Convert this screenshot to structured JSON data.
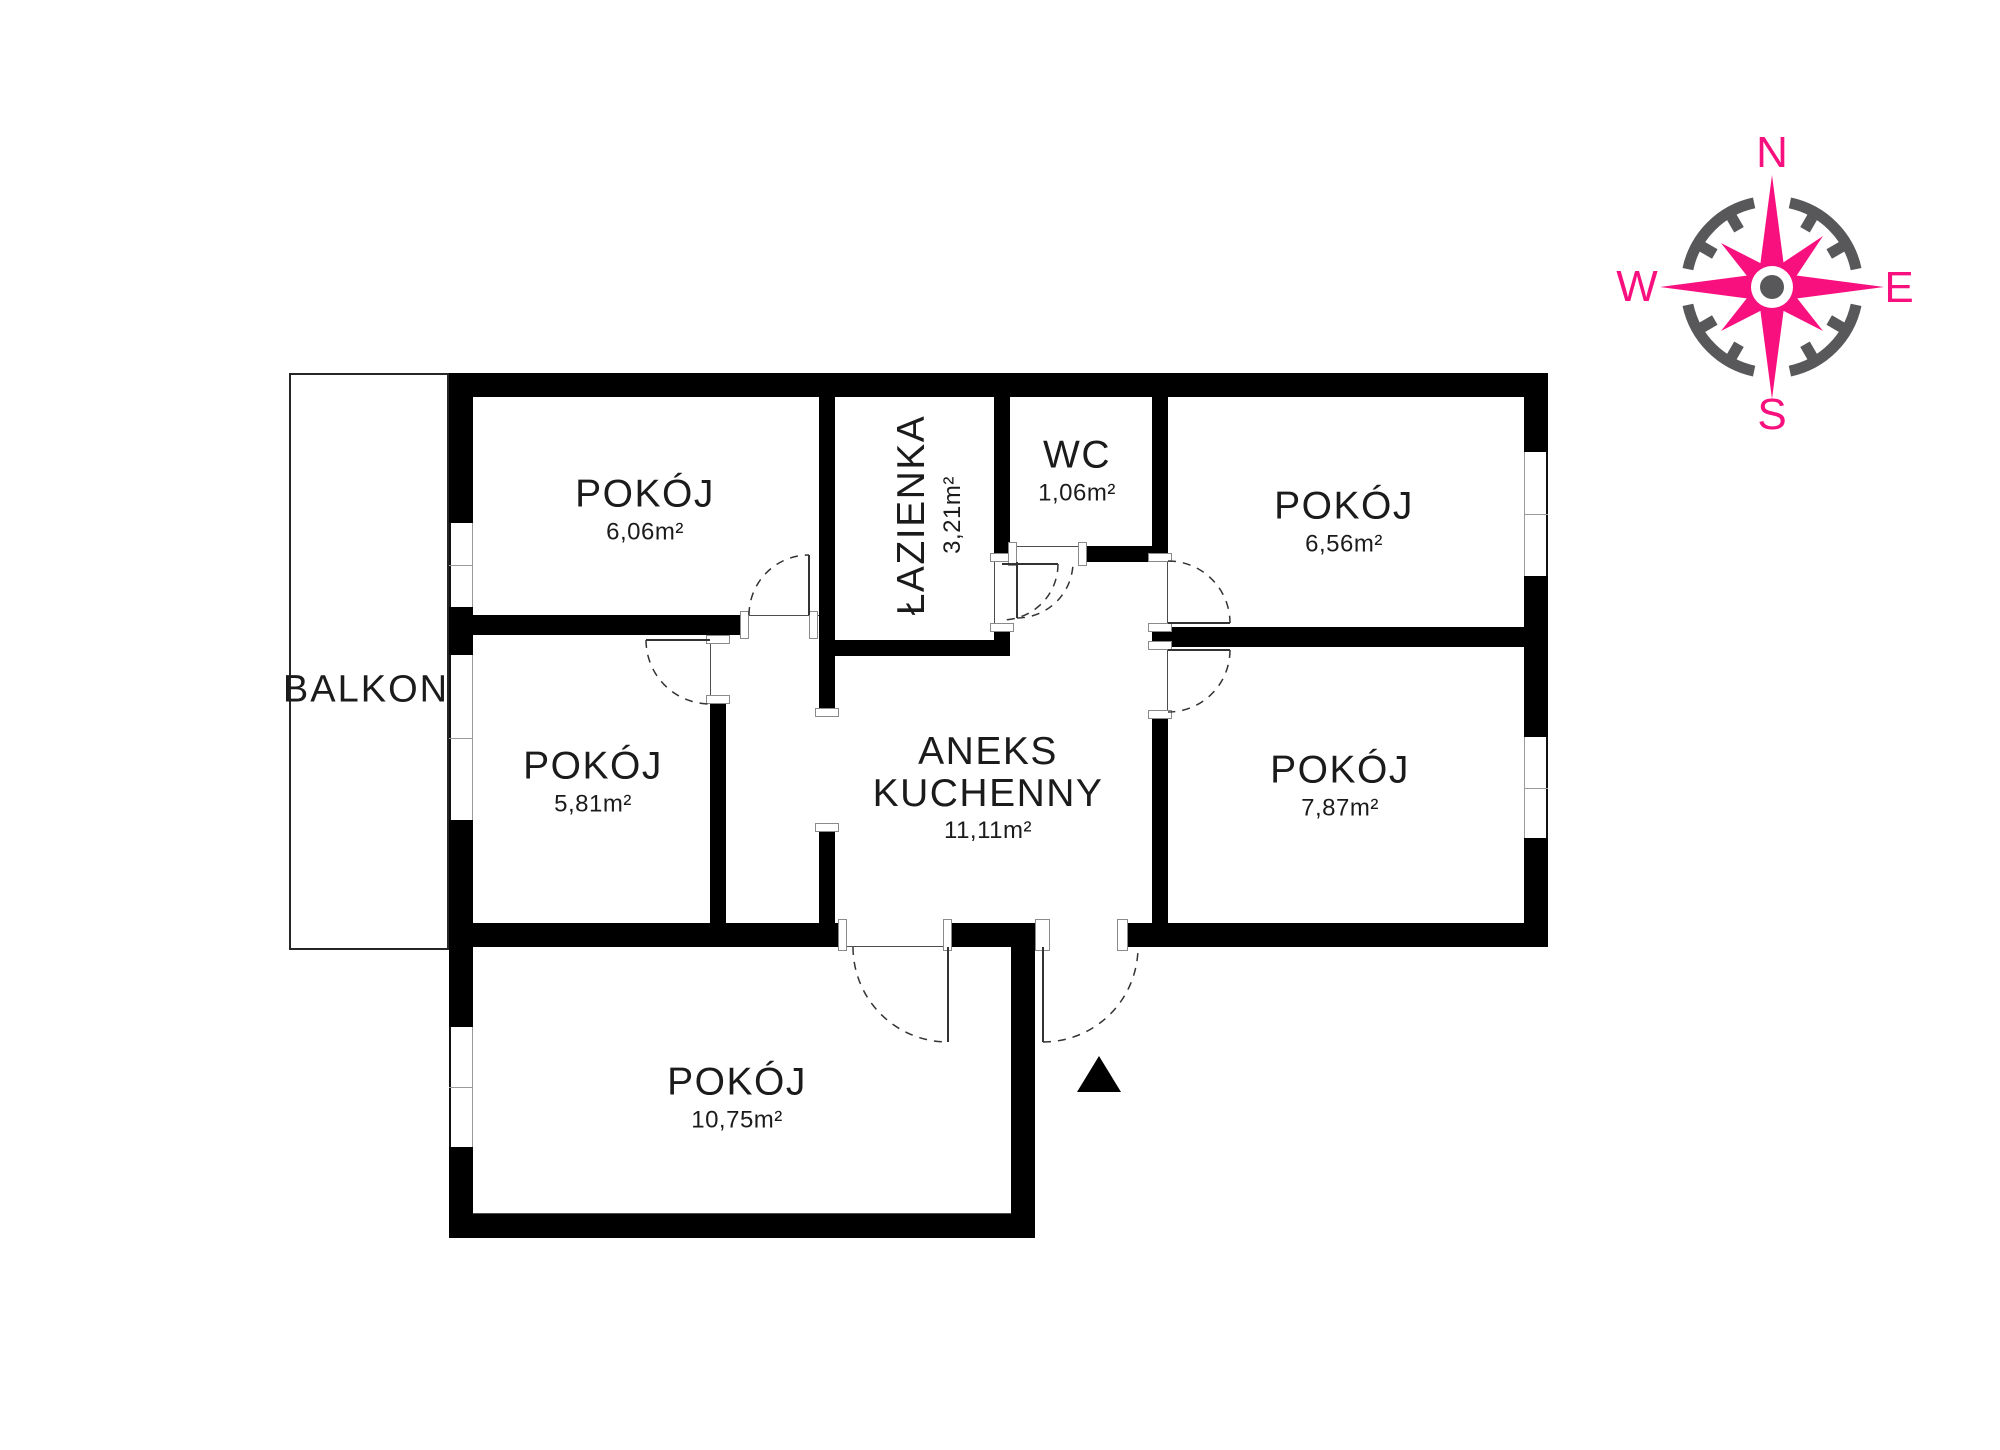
{
  "plan": {
    "balcony": {
      "label": "BALKON"
    },
    "rooms": [
      {
        "name": "POKÓJ",
        "area": "6,06m²"
      },
      {
        "name": "ŁAZIENKA",
        "area": "3,21m²"
      },
      {
        "name": "WC",
        "area": "1,06m²"
      },
      {
        "name": "POKÓJ",
        "area": "6,56m²"
      },
      {
        "name": "POKÓJ",
        "area": "5,81m²"
      },
      {
        "name": "ANEKS KUCHENNY",
        "area": "11,11m²"
      },
      {
        "name": "POKÓJ",
        "area": "7,87m²"
      },
      {
        "name": "POKÓJ",
        "area": "10,75m²"
      }
    ]
  },
  "compass": {
    "n": "N",
    "e": "E",
    "s": "S",
    "w": "W",
    "star_color": "#F8107E",
    "ring_color": "#58585A"
  },
  "colors": {
    "wall": "#000000",
    "background": "#ffffff",
    "line": "#333333"
  }
}
